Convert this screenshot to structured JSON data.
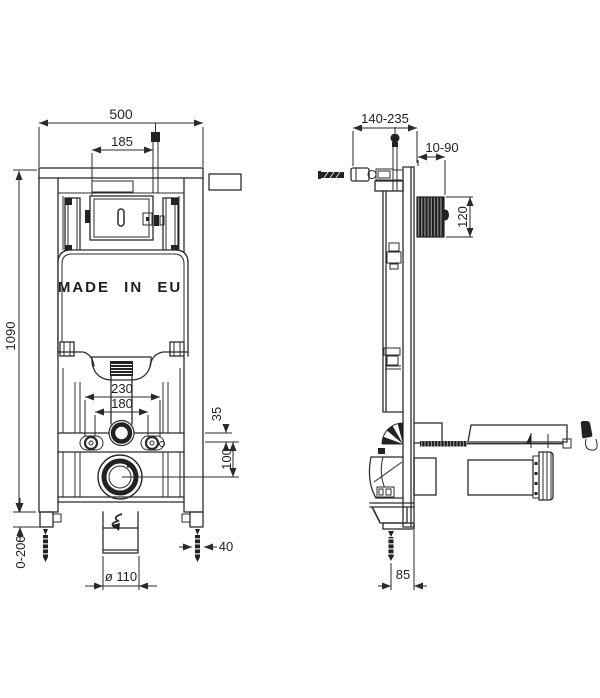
{
  "drawing": {
    "made_in_label": "MADE IN EU",
    "front_dims": {
      "width": "500",
      "supply_offset": "185",
      "height": "1090",
      "leg_adjust": "0-200",
      "fixing_outer": "230",
      "fixing_inner": "180",
      "flush_offset": "35",
      "drain_offset": "100",
      "drain_dia": "ø 110",
      "foot_width": "40"
    },
    "side_dims": {
      "depth": "140-235",
      "wall_gap": "10-90",
      "window_height": "120",
      "outlet_offset": "85"
    },
    "colors": {
      "line": "#2b2b2b",
      "background": "#ffffff"
    }
  }
}
